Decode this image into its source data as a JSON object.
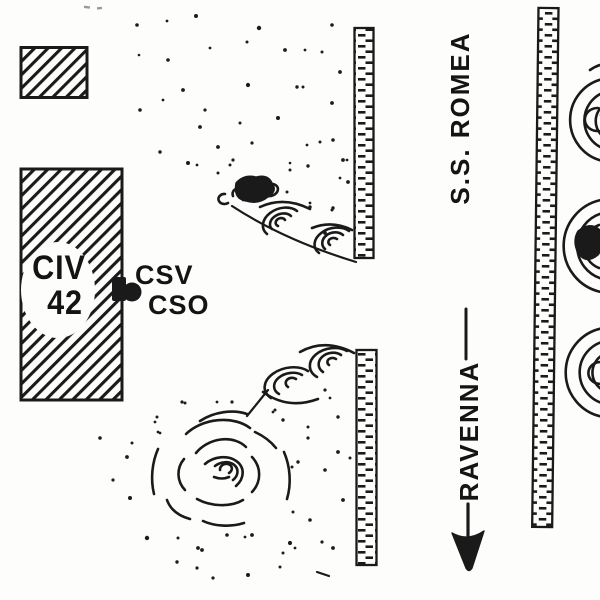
{
  "figure": {
    "building": {
      "line1": "CIV",
      "line2": "42"
    },
    "stations": {
      "csv": "CSV",
      "cso": "CSO"
    },
    "road_label": "S.S. ROMEA",
    "direction_label": "RAVENNA"
  },
  "colors": {
    "ink": "#1a1a1a",
    "paper": "#fdfdfc"
  }
}
